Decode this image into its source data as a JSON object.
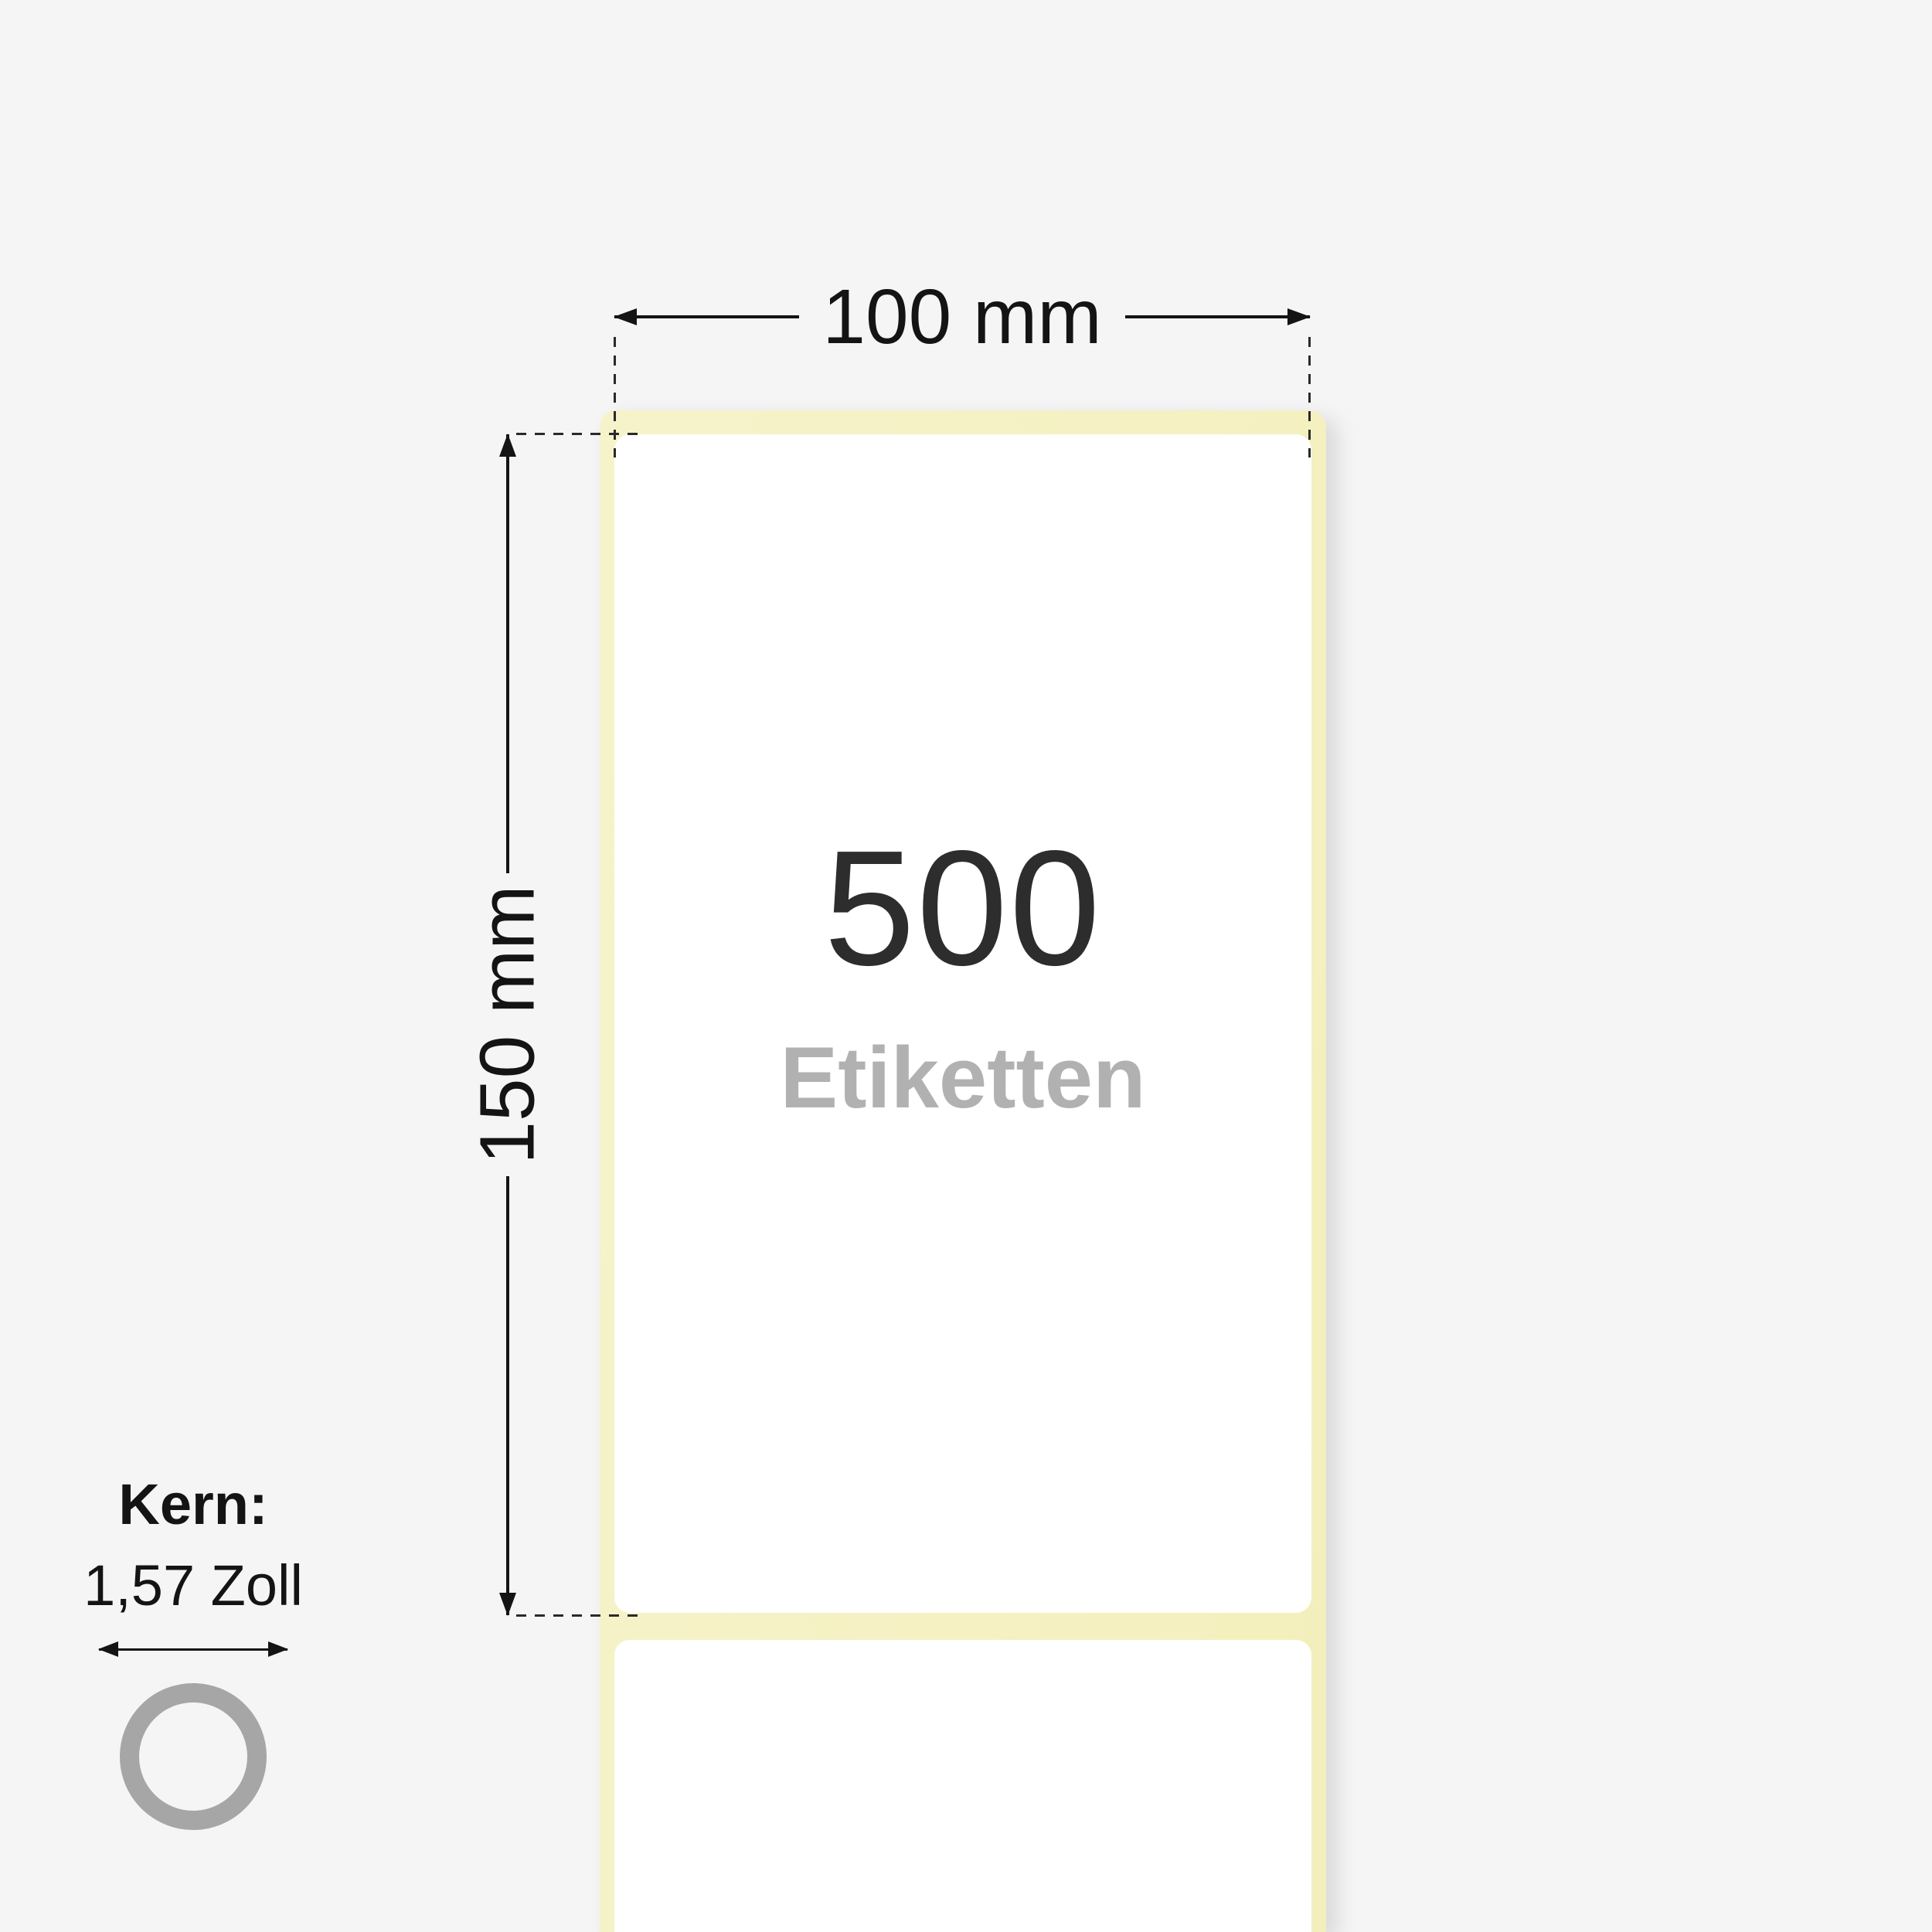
{
  "dimensions": {
    "width": "100 mm",
    "height": "150 mm"
  },
  "label": {
    "count": "500",
    "unit": "Etiketten"
  },
  "core": {
    "title": "Kern:",
    "size": "1,57 Zoll"
  },
  "icons": {
    "width_dimension": "double-arrow-horizontal",
    "height_dimension": "double-arrow-vertical",
    "core_diameter": "double-arrow-horizontal",
    "core": "ring-circle"
  },
  "colors": {
    "background": "#f5f5f6",
    "liner": "#f5f1c3",
    "label_face": "#ffffff",
    "count_text": "#2d2d2d",
    "unit_text": "#b1b1b1",
    "dimension_line": "#141414",
    "dimension_text": "#141414",
    "dash_line": "#2a2a2a",
    "core_ring": "#a6a6a6"
  }
}
